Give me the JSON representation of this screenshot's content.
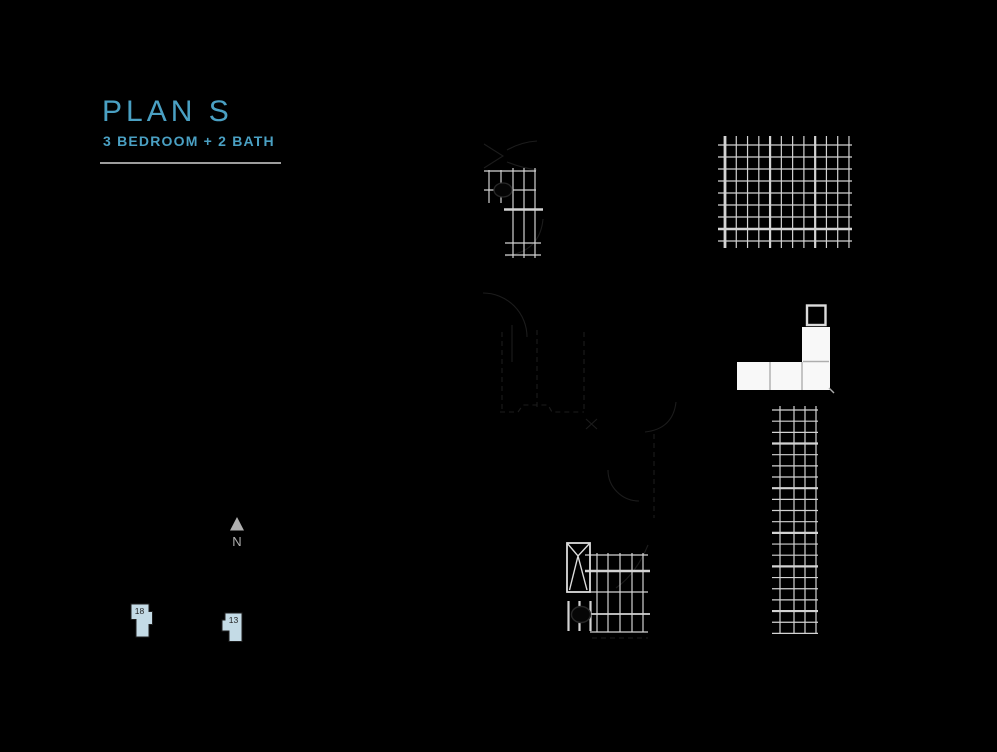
{
  "header": {
    "title": "PLAN S",
    "subtitle": "3 BEDROOM + 2 BATH"
  },
  "compass": {
    "label": "N",
    "icon": "north-arrow-icon"
  },
  "keyplan": {
    "units": [
      {
        "number": "18"
      },
      {
        "number": "13"
      }
    ]
  },
  "colors": {
    "background": "#000000",
    "accent_teal": "#4AA0C3",
    "rule_gray": "#9D9D9D",
    "plan_line": "#D3D3D3",
    "counter_fill": "#F8F8F8",
    "counter_divider": "#ADADAD",
    "fixture_stroke": "#DCDCDC",
    "compass_gray": "#AFAFAF",
    "keyplan_fill": "#C4DBE6",
    "keyplan_text": "#1F1F1F",
    "faint_line": "#1C1C1C"
  }
}
